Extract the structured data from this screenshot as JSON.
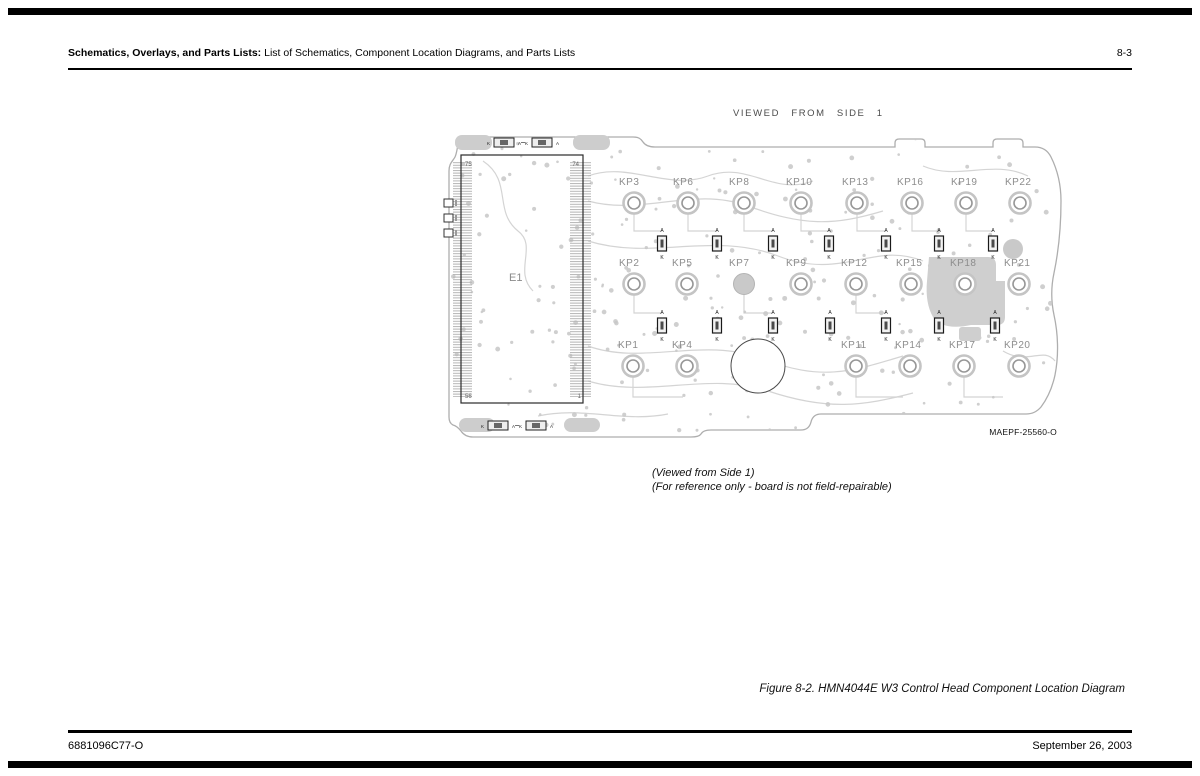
{
  "header": {
    "section_title_bold": "Schematics, Overlays, and Parts Lists:",
    "section_title_rest": " List of Schematics, Component Location Diagrams, and Parts Lists",
    "page_number": "8-3"
  },
  "footer": {
    "part_number": "6881096C77-O",
    "date": "September 26, 2003"
  },
  "figure": {
    "view_label": "VIEWED FROM SIDE 1",
    "artwork_id": "MAEPF-25560-O",
    "note_line1": "(Viewed from Side 1)",
    "note_line2": "(For reference only - board is not field-repairable)",
    "caption": "Figure 8-2. HMN4044E W3 Control Head Component Location Diagram"
  },
  "board": {
    "ic": {
      "ref": "E1",
      "pin_top_left": "75",
      "pin_top_right": "74",
      "pin_bottom_left": "56",
      "pin_bottom_right": "1"
    },
    "diode_markers": {
      "anode": "A",
      "cathode": "K"
    },
    "button_rows": [
      {
        "name": "row-1",
        "buttons": [
          {
            "label": "KP3",
            "x": 191,
            "y": 72
          },
          {
            "label": "KP6",
            "x": 245,
            "y": 72
          },
          {
            "label": "KP8",
            "x": 301,
            "y": 72
          },
          {
            "label": "KP10",
            "x": 358,
            "y": 72
          },
          {
            "label": "KP13",
            "x": 414,
            "y": 72
          },
          {
            "label": "KP16",
            "x": 469,
            "y": 72
          },
          {
            "label": "KP19",
            "x": 523,
            "y": 72
          },
          {
            "label": "KP22",
            "x": 577,
            "y": 72
          }
        ]
      },
      {
        "name": "row-2",
        "buttons": [
          {
            "label": "KP2",
            "x": 191,
            "y": 153
          },
          {
            "label": "KP5",
            "x": 244,
            "y": 153
          },
          {
            "label": "KP7",
            "x": 301,
            "y": 153,
            "filled": true
          },
          {
            "label": "KP9",
            "x": 358,
            "y": 153
          },
          {
            "label": "KP12",
            "x": 413,
            "y": 153
          },
          {
            "label": "KP15",
            "x": 468,
            "y": 153
          },
          {
            "label": "KP18",
            "x": 522,
            "y": 153
          },
          {
            "label": "KP21",
            "x": 576,
            "y": 153
          }
        ]
      },
      {
        "name": "row-3",
        "buttons": [
          {
            "label": "KP1",
            "x": 190,
            "y": 235
          },
          {
            "label": "KP4",
            "x": 244,
            "y": 235
          },
          {
            "label": "KP11",
            "x": 413,
            "y": 235
          },
          {
            "label": "KP14",
            "x": 467,
            "y": 235
          },
          {
            "label": "KP17",
            "x": 521,
            "y": 235
          },
          {
            "label": "KP20",
            "x": 576,
            "y": 235
          }
        ]
      }
    ],
    "diode_rows": [
      {
        "rect_y": 105,
        "xs": [
          219,
          274,
          330,
          386,
          443,
          496,
          550
        ]
      },
      {
        "rect_y": 187,
        "xs": [
          219,
          274,
          330,
          387,
          443,
          496,
          552
        ]
      }
    ],
    "edge_diodes": [
      {
        "x": 51,
        "y": 7
      },
      {
        "x": 89,
        "y": 7
      },
      {
        "x": 45,
        "y": 290
      },
      {
        "x": 83,
        "y": 290
      }
    ]
  }
}
